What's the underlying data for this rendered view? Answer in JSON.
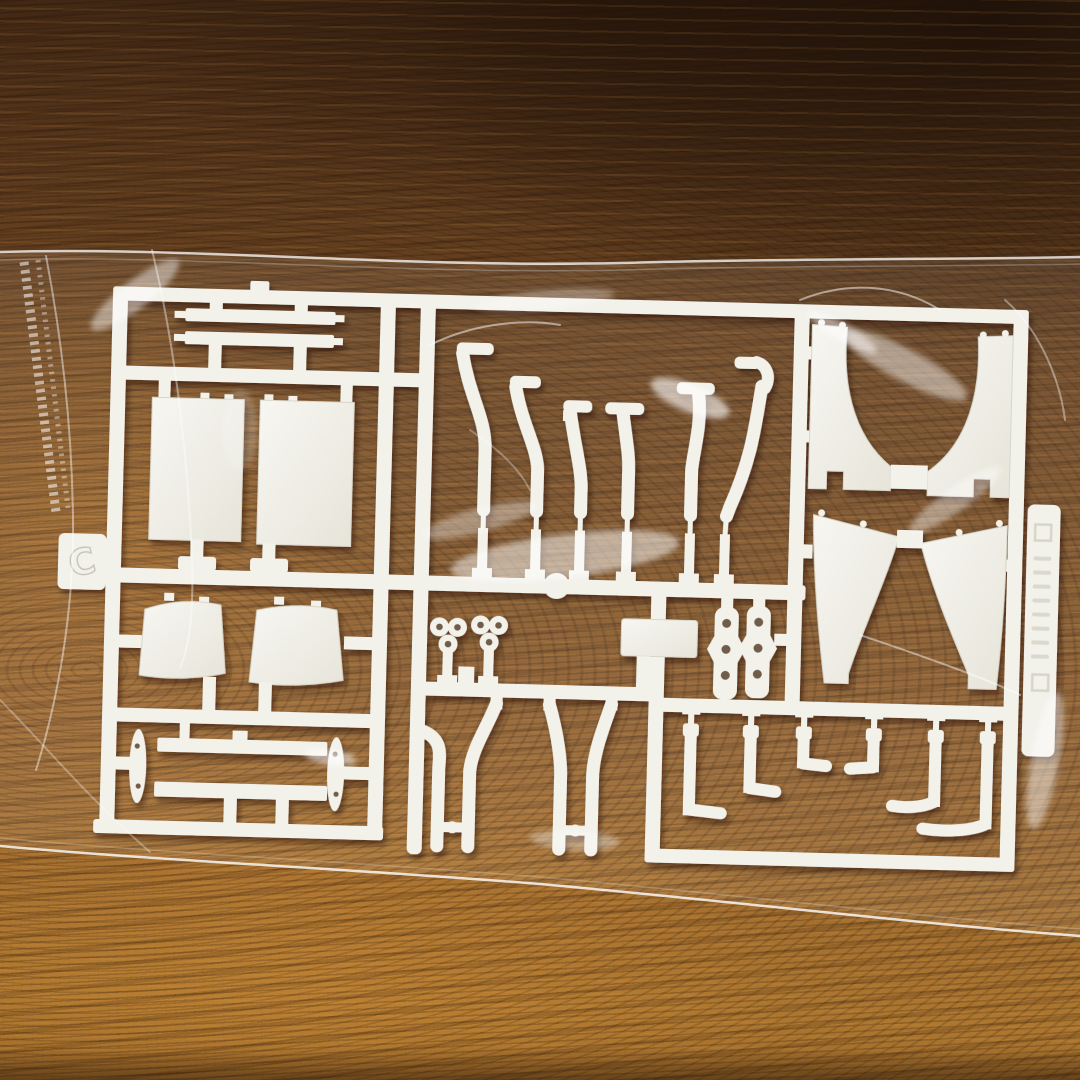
{
  "scene": {
    "description": "White plastic model-kit parts sprue sealed inside a clear plastic bag, lying on a dark wooden table",
    "surface": "wooden table with horizontal grain, dark at top and golden at bottom",
    "bag": "clear polyethylene bag with serrated open edge at the left and glossy specular reflections",
    "lighting": "overhead light producing white streak reflections on the bag film"
  },
  "colors": {
    "wood_dark": "#33200f",
    "wood_deep": "#241507",
    "wood_mid": "#6f4721",
    "wood_light": "#b0782f",
    "wood_grain": "#2e1a08",
    "plastic": "#f2f1ea",
    "plastic_shade": "#d8d6ca",
    "bag_highlight": "#ffffff"
  },
  "sprue": {
    "tab_letter": "C",
    "material": "white styrene runner",
    "parts": [
      {
        "name": "thin flat strips",
        "count": 2
      },
      {
        "name": "rectangular panels",
        "count": 2
      },
      {
        "name": "curved pipes",
        "count": 6
      },
      {
        "name": "curved seat panels",
        "count": 2
      },
      {
        "name": "oval end plates",
        "count": 2
      },
      {
        "name": "long side strips",
        "count": 2
      },
      {
        "name": "three-hole clusters",
        "count": 2
      },
      {
        "name": "rectangular block",
        "count": 1
      },
      {
        "name": "forked tubes",
        "count": 4
      },
      {
        "name": "three-hole links",
        "count": 2
      },
      {
        "name": "L-shaped hooks",
        "count": 6
      },
      {
        "name": "curved fender panels",
        "count": 4
      }
    ]
  }
}
